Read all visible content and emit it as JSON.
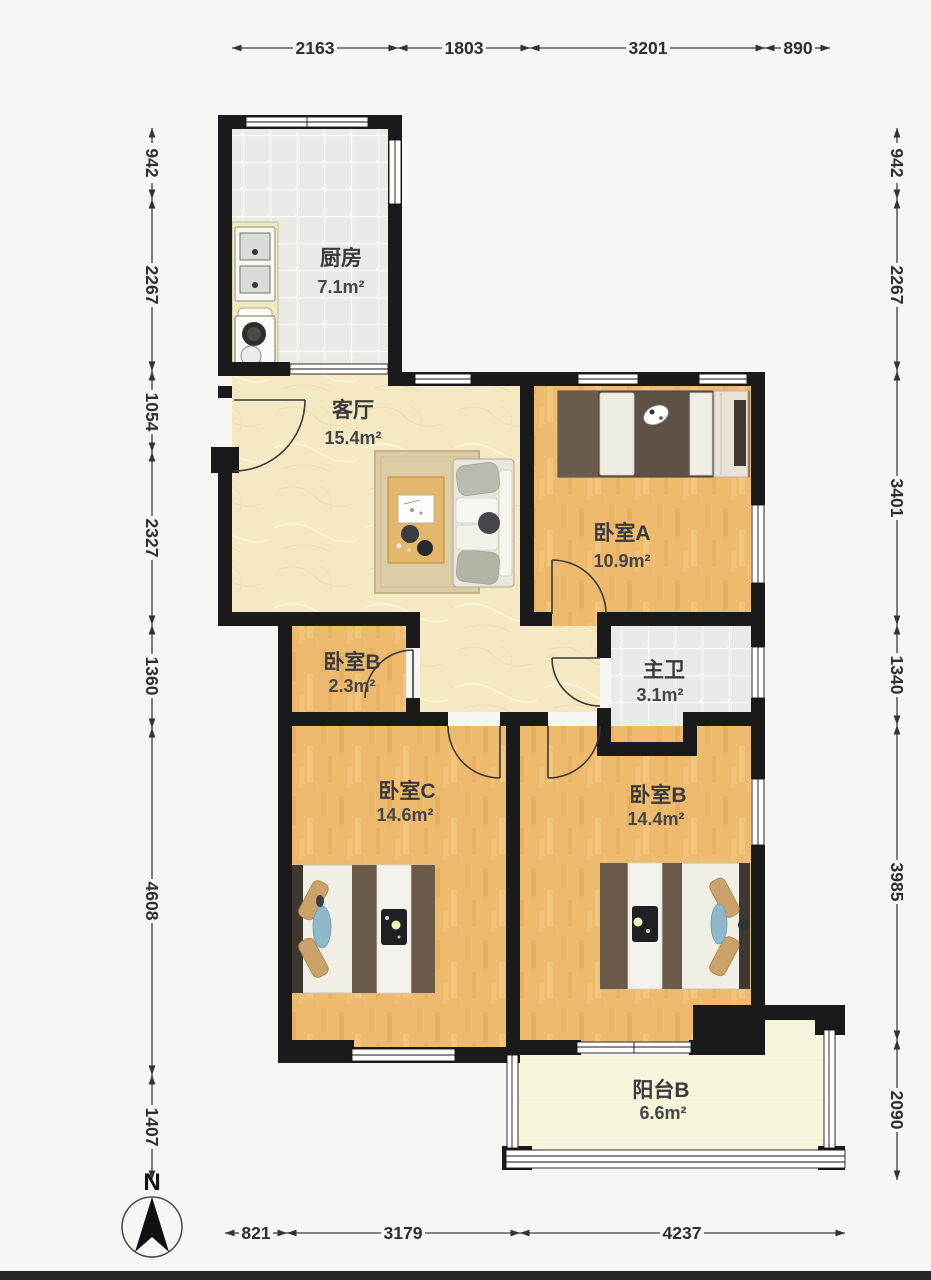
{
  "compass": {
    "label": "N"
  },
  "rooms": [
    {
      "name": "厨房",
      "area": "7.1m²"
    },
    {
      "name": "客厅",
      "area": "15.4m²"
    },
    {
      "name": "卧室A",
      "area": "10.9m²"
    },
    {
      "name": "卧室B",
      "area": "2.3m²"
    },
    {
      "name": "主卫",
      "area": "3.1m²"
    },
    {
      "name": "卧室C",
      "area": "14.6m²"
    },
    {
      "name": "卧室B",
      "area": "14.4m²"
    },
    {
      "name": "阳台B",
      "area": "6.6m²"
    }
  ],
  "dimensions_mm": {
    "top": [
      "2163",
      "1803",
      "3201",
      "890"
    ],
    "left": [
      "942",
      "2267",
      "1054",
      "2327",
      "1360",
      "4608",
      "1407"
    ],
    "right": [
      "942",
      "2267",
      "3401",
      "1340",
      "3985",
      "2090"
    ],
    "bottom": [
      "821",
      "3179",
      "4237"
    ]
  },
  "colors": {
    "wall": "#1a1a1a",
    "wood_floor": "#eeba6d",
    "marble_floor": "#f5e9c4",
    "tile_floor": "#e9ebe7",
    "balcony_floor": "#f7f5dc",
    "dimension_text": "#2e2e2e"
  }
}
